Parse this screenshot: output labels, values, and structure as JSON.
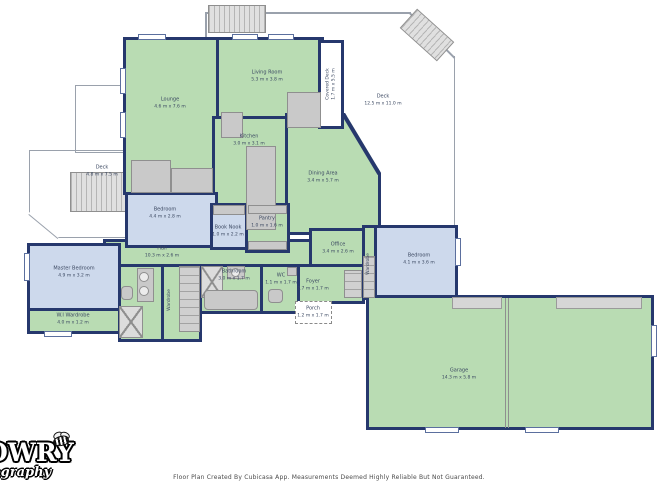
{
  "footer": {
    "text": "Floor Plan Created By Cubicasa App. Measurements Deemed Highly Reliable But Not Guaranteed."
  },
  "watermark": {
    "line1": "OWRY",
    "line2": "tography",
    "icon": "bee-icon"
  },
  "colors": {
    "wall": "#26386d",
    "room_green": "#b9dcb3",
    "room_blue": "#cdd9ec",
    "fixture": "#c9c9c9",
    "fixture_border": "#8f8f8f",
    "deck_outline": "#9aa1ac",
    "label_text": "#3c4962"
  },
  "rooms": {
    "lounge": {
      "name": "Lounge",
      "dims": "4.6 m x 7.6 m"
    },
    "living_room": {
      "name": "Living Room",
      "dims": "5.3 m x 3.8 m"
    },
    "covered_deck": {
      "name": "Covered Deck",
      "dims": "1.7 m x 5.5 m"
    },
    "deck_top": {
      "name": "Deck",
      "dims": "12.5 m x 11.0 m"
    },
    "kitchen": {
      "name": "Kitchen",
      "dims": "3.0 m x 3.1 m"
    },
    "dining_area": {
      "name": "Dining Area",
      "dims": "3.4 m x 5.7 m"
    },
    "deck_left": {
      "name": "Deck",
      "dims": "4.8 m x 7.5 m"
    },
    "bedroom_left": {
      "name": "Bedroom",
      "dims": "4.4 m x 2.8 m"
    },
    "book_nook": {
      "name": "Book Nook",
      "dims": "1.0 m x 2.2 m"
    },
    "pantry": {
      "name": "Pantry",
      "dims": "1.0 m x 1.6 m"
    },
    "office": {
      "name": "Office",
      "dims": "3.4 m x 2.6 m"
    },
    "bedroom_right": {
      "name": "Bedroom",
      "dims": "4.1 m x 3.6 m"
    },
    "hall": {
      "name": "Hall",
      "dims": "10.3 m x 2.6 m"
    },
    "master_bedroom": {
      "name": "Master Bedroom",
      "dims": "4.9 m x 3.2 m"
    },
    "wi_wardrobe": {
      "name": "W.I Wardrobe",
      "dims": "4.0 m x 1.2 m"
    },
    "bathroom": {
      "name": "Bathroom",
      "dims": "3.0 m x 1.7 m"
    },
    "wc": {
      "name": "WC",
      "dims": "1.1 m x 1.7 m"
    },
    "foyer": {
      "name": "Foyer",
      "dims": "2.7 m x 1.7 m"
    },
    "porch": {
      "name": "Porch",
      "dims": "1.2 m x 1.7 m"
    },
    "garage": {
      "name": "Garage",
      "dims": "14.3 m x 5.8 m"
    },
    "wardrobe_center": {
      "name": "Wardrobe",
      "dims": ""
    },
    "wardrobe_right": {
      "name": "Wardrobe",
      "dims": ""
    }
  }
}
